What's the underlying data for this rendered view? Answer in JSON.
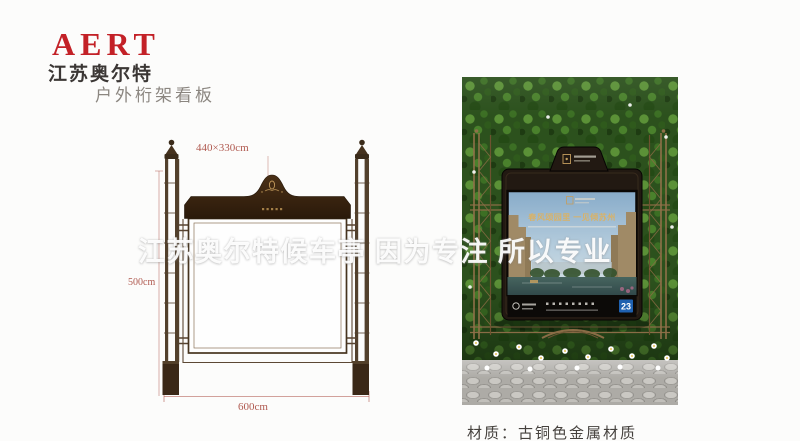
{
  "brand": {
    "logo": "AERT",
    "company": "江苏奥尔特",
    "product_title": "户外桁架看板"
  },
  "drawing": {
    "dim_top": "440×330cm",
    "dim_left": "500cm",
    "dim_bottom": "600cm"
  },
  "watermark": "江苏奥尔特候车亭  因为专注 所以专业",
  "ad": {
    "headline": "春风颂园里 一见倾苏州",
    "corner_number": "23"
  },
  "material_note": "材质：古铜色金属材质",
  "colors": {
    "logo_red": "#c32127",
    "dimension_red": "#b05a50",
    "bronze": "#8a6c46",
    "header_brown": "#35240f",
    "wall_green": "#2c511d",
    "gold": "#c9a35f"
  }
}
